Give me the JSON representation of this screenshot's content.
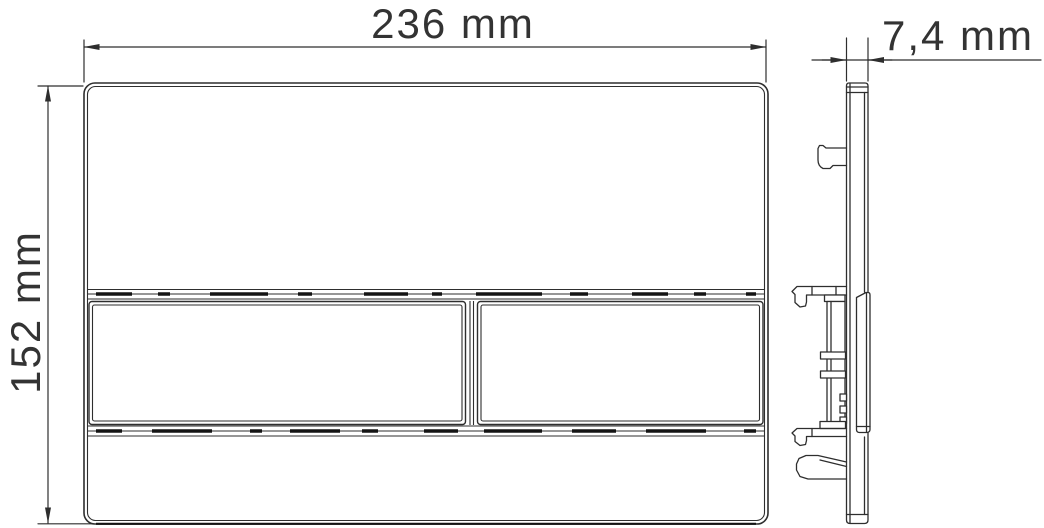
{
  "drawing": {
    "type": "technical-dimension-drawing",
    "subject": "flush-plate",
    "dimensions": {
      "width": "236 mm",
      "height": "152 mm",
      "thickness": "7,4 mm"
    },
    "colors": {
      "line": "#2e2e2e",
      "text": "#333333",
      "shadow": "#141414",
      "background": "#ffffff"
    }
  }
}
